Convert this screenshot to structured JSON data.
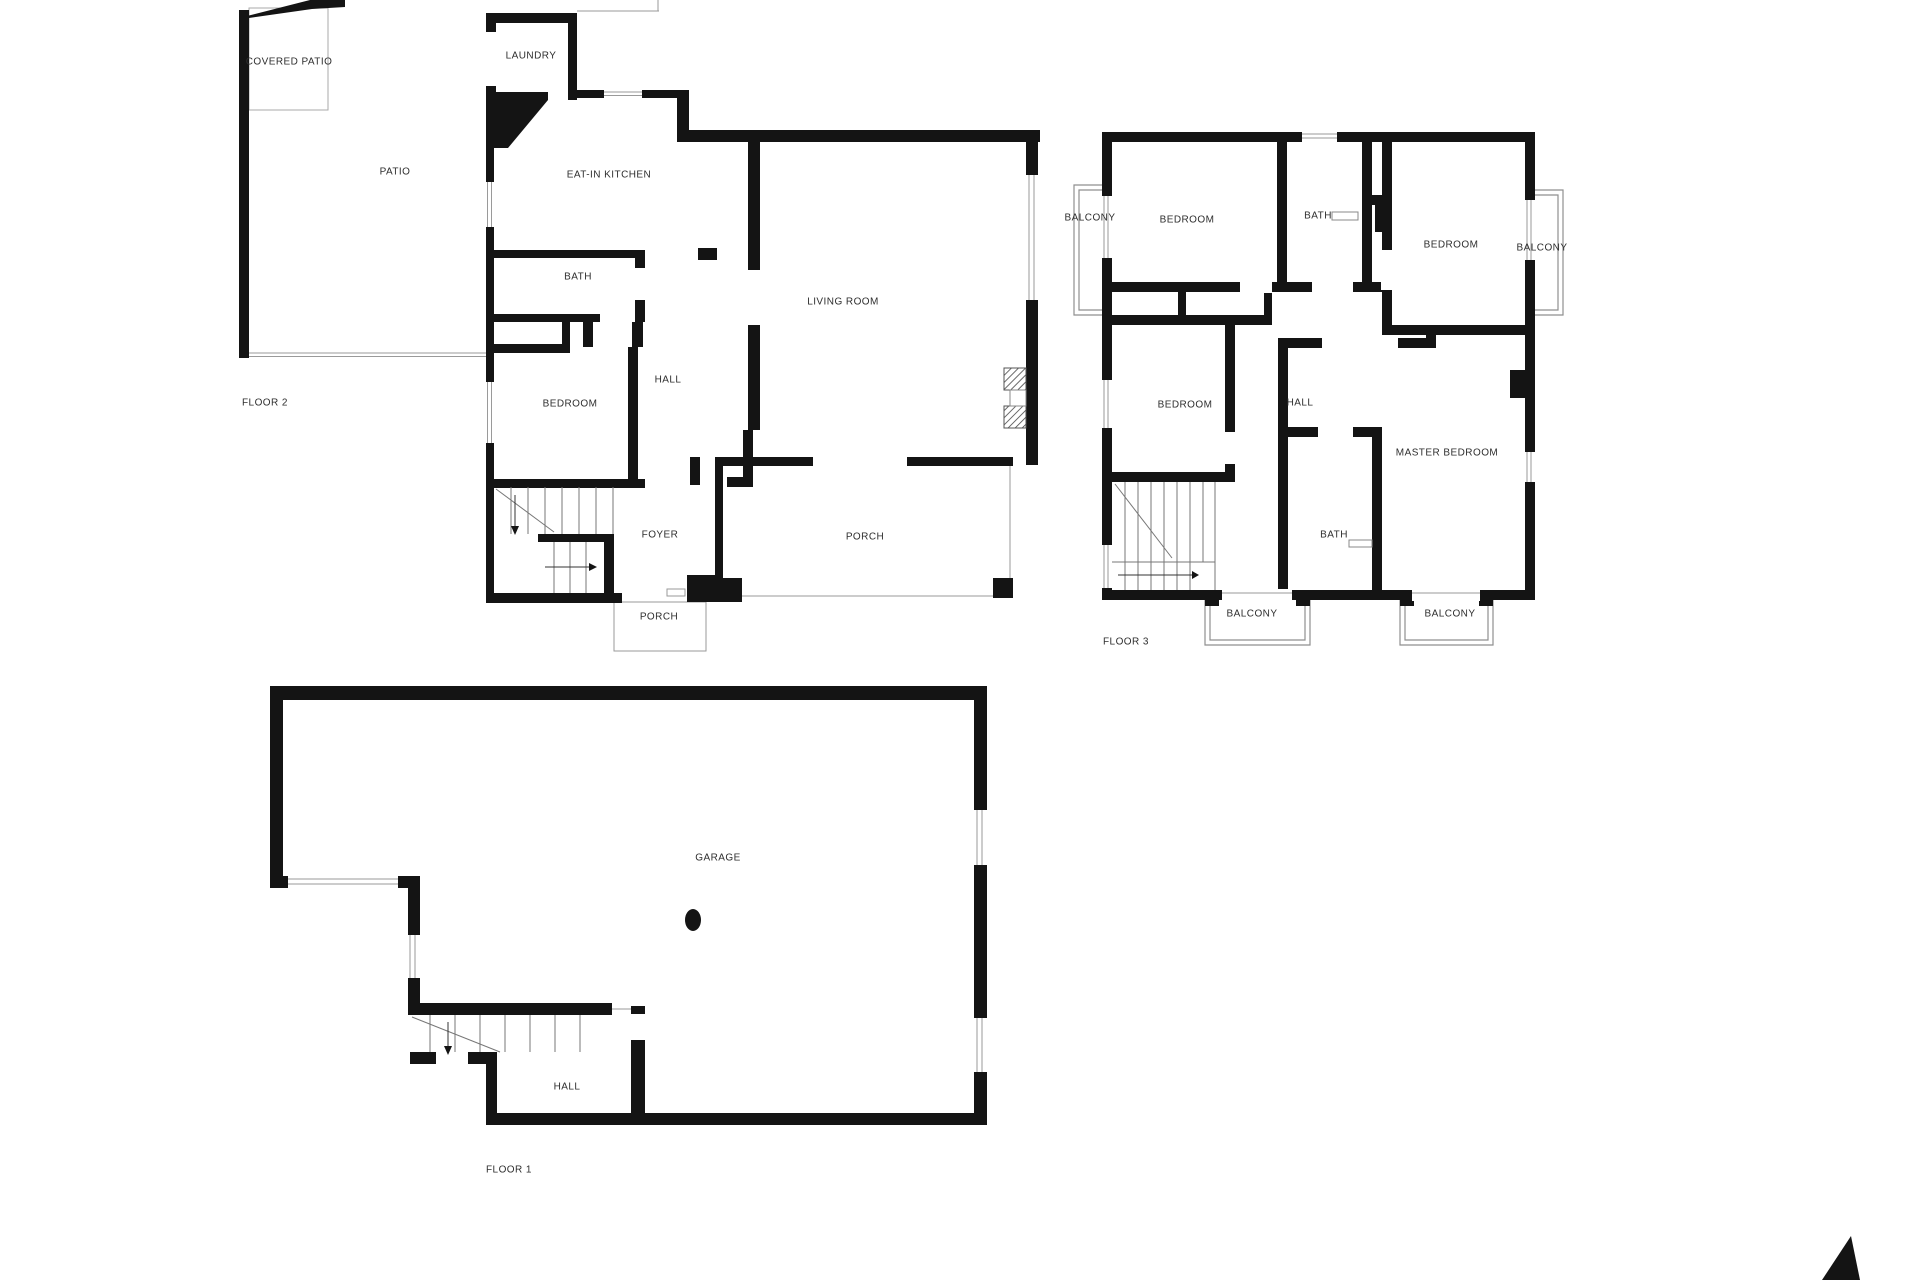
{
  "palette": {
    "background": "#ffffff",
    "wall": "#141414",
    "thin_line": "#8f8f8f",
    "stair_line": "#777777",
    "label": "#2e2e2e"
  },
  "floors": {
    "f2": {
      "title": "FLOOR 2",
      "rooms": {
        "covered_patio": "COVERED PATIO",
        "patio": "PATIO",
        "laundry": "LAUNDRY",
        "kitchen": "EAT-IN KITCHEN",
        "bath": "BATH",
        "hall": "HALL",
        "bedroom": "BEDROOM",
        "living_room": "LIVING ROOM",
        "foyer": "FOYER",
        "porch_front": "PORCH",
        "porch_entry": "PORCH"
      }
    },
    "f3": {
      "title": "FLOOR 3",
      "rooms": {
        "balcony_left": "BALCONY",
        "bedroom_nw": "BEDROOM",
        "bath_top": "BATH",
        "bedroom_ne": "BEDROOM",
        "balcony_right": "BALCONY",
        "bedroom_w": "BEDROOM",
        "hall": "HALL",
        "master_bedroom": "MASTER BEDROOM",
        "bath_master": "BATH",
        "balcony_sw": "BALCONY",
        "balcony_se": "BALCONY"
      }
    },
    "f1": {
      "title": "FLOOR 1",
      "rooms": {
        "garage": "GARAGE",
        "hall": "HALL"
      }
    }
  }
}
